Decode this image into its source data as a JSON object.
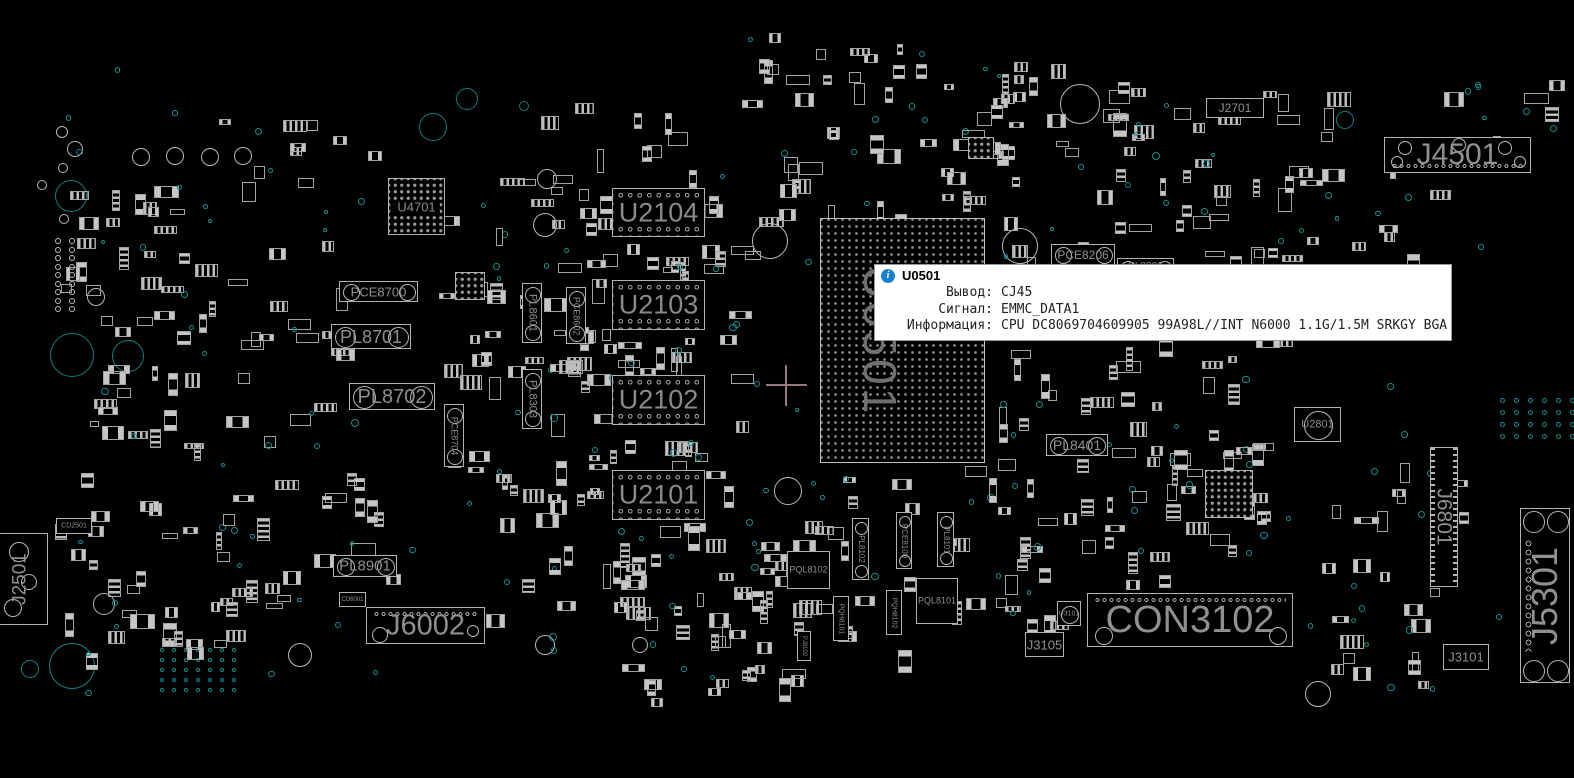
{
  "tooltip": {
    "title": "U0501",
    "rows": [
      {
        "label": "Вывод:",
        "value": "CJ45"
      },
      {
        "label": "Сигнал:",
        "value": "EMMC_DATA1"
      },
      {
        "label": "Информация:",
        "value": "CPU DC8069704609905 99A98L//INT N6000 1.1G/1.5M SRKGY BGA"
      }
    ]
  },
  "colors": {
    "background": "#000000",
    "outline": "#b2b2b2",
    "label": "#8e8e8e",
    "via": "#0d9090",
    "info_icon": "#1b7fd0",
    "crosshair": "#96787d"
  },
  "components": [
    {
      "label": "U0501",
      "type": "bga",
      "x": 820,
      "y": 218,
      "w": 165,
      "h": 245,
      "fs": 46,
      "rot": 90
    },
    {
      "label": "U2104",
      "type": "mem",
      "x": 612,
      "y": 188,
      "w": 93,
      "h": 49,
      "fs": 27
    },
    {
      "label": "U2103",
      "type": "mem",
      "x": 612,
      "y": 280,
      "w": 93,
      "h": 50,
      "fs": 27
    },
    {
      "label": "U2102",
      "type": "mem",
      "x": 612,
      "y": 375,
      "w": 93,
      "h": 50,
      "fs": 27
    },
    {
      "label": "U2101",
      "type": "mem",
      "x": 612,
      "y": 470,
      "w": 93,
      "h": 50,
      "fs": 27
    },
    {
      "label": "U4701",
      "type": "chip",
      "x": 388,
      "y": 178,
      "w": 57,
      "h": 57,
      "fs": 13
    },
    {
      "label": "J4501",
      "type": "conn",
      "x": 1384,
      "y": 137,
      "w": 147,
      "h": 36,
      "fs": 30
    },
    {
      "label": "J2701",
      "type": "conn",
      "x": 1206,
      "y": 98,
      "w": 58,
      "h": 20,
      "fs": 12
    },
    {
      "label": "CON3102",
      "type": "conn",
      "x": 1087,
      "y": 593,
      "w": 206,
      "h": 54,
      "fs": 38
    },
    {
      "label": "J6002",
      "type": "conn",
      "x": 366,
      "y": 607,
      "w": 119,
      "h": 37,
      "fs": 29
    },
    {
      "label": "J6801",
      "type": "vconn",
      "x": 1430,
      "y": 447,
      "w": 28,
      "h": 140,
      "fs": 21,
      "rot": 90
    },
    {
      "label": "J5301",
      "type": "vconn",
      "x": 1520,
      "y": 508,
      "w": 50,
      "h": 175,
      "fs": 36,
      "rot": -90
    },
    {
      "label": "J3101",
      "type": "conn",
      "x": 1443,
      "y": 644,
      "w": 46,
      "h": 26,
      "fs": 13
    },
    {
      "label": "J3105",
      "type": "conn",
      "x": 1025,
      "y": 632,
      "w": 39,
      "h": 25,
      "fs": 13
    },
    {
      "label": "J2501",
      "type": "vconn",
      "x": -8,
      "y": 533,
      "w": 56,
      "h": 92,
      "fs": 19,
      "rot": -90
    },
    {
      "label": "PL8702",
      "type": "ind",
      "x": 349,
      "y": 383,
      "w": 86,
      "h": 27,
      "fs": 20
    },
    {
      "label": "PL8701",
      "type": "ind",
      "x": 331,
      "y": 324,
      "w": 80,
      "h": 25,
      "fs": 18
    },
    {
      "label": "PCE8700",
      "type": "ind",
      "x": 339,
      "y": 281,
      "w": 79,
      "h": 21,
      "fs": 13
    },
    {
      "label": "PL8901",
      "type": "ind",
      "x": 333,
      "y": 555,
      "w": 64,
      "h": 22,
      "fs": 15
    },
    {
      "label": "PL8401",
      "type": "ind",
      "x": 1046,
      "y": 434,
      "w": 62,
      "h": 22,
      "fs": 14
    },
    {
      "label": "PCE8206",
      "type": "ind",
      "x": 1051,
      "y": 244,
      "w": 64,
      "h": 21,
      "fs": 12
    },
    {
      "label": "PL8201",
      "type": "ind",
      "x": 1117,
      "y": 258,
      "w": 57,
      "h": 18,
      "fs": 10
    },
    {
      "label": "PL8601",
      "type": "vind",
      "x": 522,
      "y": 283,
      "w": 20,
      "h": 60,
      "fs": 11,
      "rot": 90
    },
    {
      "label": "PCE8602",
      "type": "vind",
      "x": 566,
      "y": 287,
      "w": 20,
      "h": 57,
      "fs": 9,
      "rot": 90
    },
    {
      "label": "PL8303",
      "type": "vind",
      "x": 522,
      "y": 369,
      "w": 20,
      "h": 60,
      "fs": 11,
      "rot": 90
    },
    {
      "label": "PCE8704",
      "type": "vind",
      "x": 444,
      "y": 404,
      "w": 20,
      "h": 63,
      "fs": 9,
      "rot": 90
    },
    {
      "label": "U2801",
      "type": "circchip",
      "x": 1294,
      "y": 407,
      "w": 47,
      "h": 35,
      "fs": 11
    },
    {
      "label": "U3101",
      "type": "circchip",
      "x": 1057,
      "y": 601,
      "w": 24,
      "h": 25,
      "fs": 7
    },
    {
      "label": "PQL8102",
      "type": "box",
      "x": 787,
      "y": 551,
      "w": 43,
      "h": 38,
      "fs": 9
    },
    {
      "label": "PQL8101",
      "type": "box",
      "x": 916,
      "y": 578,
      "w": 42,
      "h": 46,
      "fs": 9
    },
    {
      "label": "PCE8100",
      "type": "vind",
      "x": 896,
      "y": 512,
      "w": 16,
      "h": 57,
      "fs": 8,
      "rot": 90
    },
    {
      "label": "PL8102",
      "type": "vind",
      "x": 852,
      "y": 518,
      "w": 17,
      "h": 62,
      "fs": 8,
      "rot": 90
    },
    {
      "label": "PL8101",
      "type": "vind",
      "x": 937,
      "y": 512,
      "w": 17,
      "h": 55,
      "fs": 8,
      "rot": 90
    },
    {
      "label": "PQH8101",
      "type": "vbox",
      "x": 833,
      "y": 596,
      "w": 16,
      "h": 45,
      "fs": 7,
      "rot": 90
    },
    {
      "label": "PQH8102",
      "type": "vbox",
      "x": 886,
      "y": 590,
      "w": 16,
      "h": 45,
      "fs": 7,
      "rot": 90
    },
    {
      "label": "PJ8102",
      "type": "vbox",
      "x": 797,
      "y": 631,
      "w": 14,
      "h": 30,
      "fs": 6,
      "rot": 90
    },
    {
      "label": "CD2501",
      "type": "box",
      "x": 56,
      "y": 518,
      "w": 36,
      "h": 16,
      "fs": 7
    },
    {
      "label": "CD6001",
      "type": "box",
      "x": 339,
      "y": 592,
      "w": 27,
      "h": 15,
      "fs": 6
    }
  ]
}
